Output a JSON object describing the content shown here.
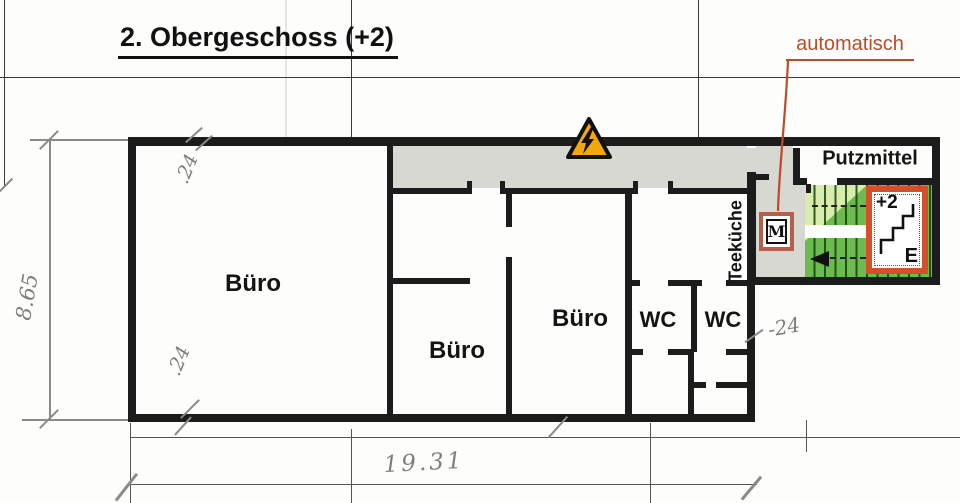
{
  "title": "2. Obergeschoss (+2)",
  "rooms": {
    "bueros": [
      "Büro",
      "Büro",
      "Büro"
    ],
    "wcs": [
      "WC",
      "WC"
    ],
    "teekueche": "Teeküche",
    "putzmittel": "Putzmittel"
  },
  "stairwell": {
    "auto_label": "automatisch",
    "motor_symbol": "M",
    "sign_level": "+2",
    "sign_exit": "E"
  },
  "dimensions": {
    "building_height_m": "8.65",
    "building_width_m": "19.31",
    "wall_thickness_top": ".24",
    "wall_thickness_bottom": ".24",
    "wall_thickness_right": "-24"
  },
  "colors": {
    "wall_black": "#1c1c1c",
    "corridor_gray": "#d8d8d3",
    "stair_green": "#6cbb4f",
    "stair_green_light": "#d8edab",
    "sign_orange": "#d4502a",
    "motor_border_red": "#b5604a",
    "annotation_red": "#bf4a28",
    "warning_amber": "#f3a70a",
    "pencil_gray": "#7e7e7e"
  }
}
